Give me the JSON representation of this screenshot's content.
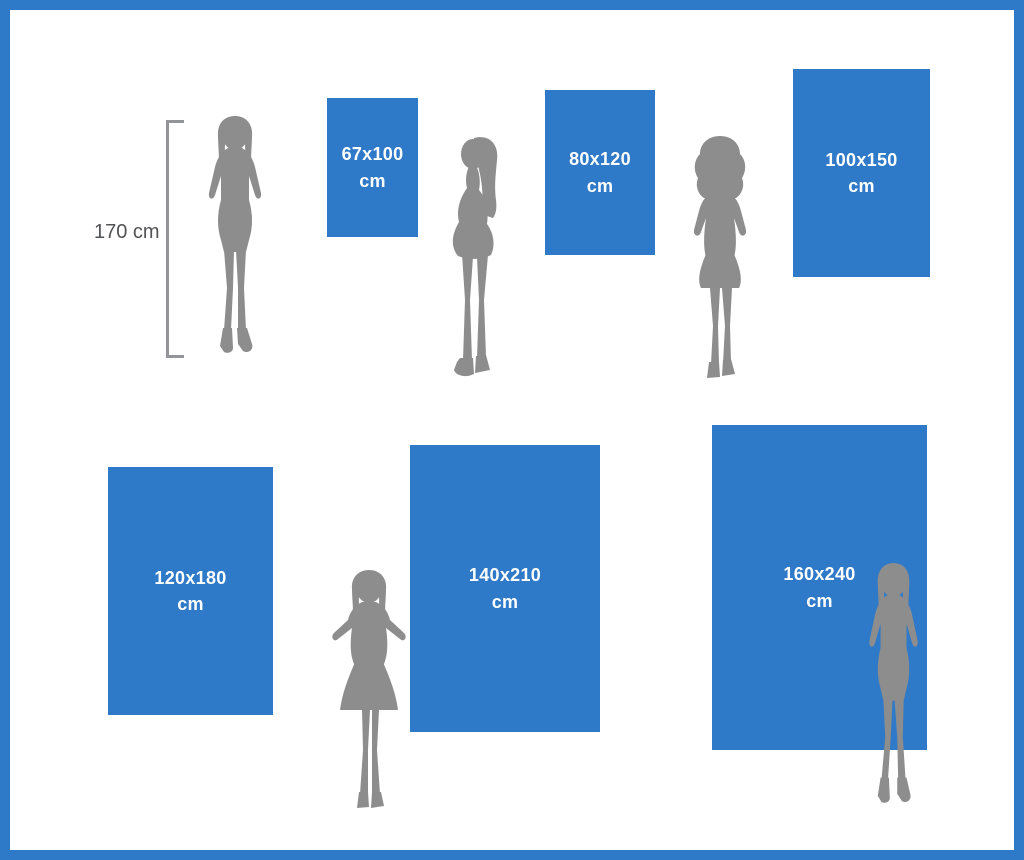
{
  "reference": {
    "height_label": "170 cm"
  },
  "sizes": [
    {
      "dimensions": "67x100",
      "unit": "cm"
    },
    {
      "dimensions": "80x120",
      "unit": "cm"
    },
    {
      "dimensions": "100x150",
      "unit": "cm"
    },
    {
      "dimensions": "120x180",
      "unit": "cm"
    },
    {
      "dimensions": "140x210",
      "unit": "cm"
    },
    {
      "dimensions": "160x240",
      "unit": "cm"
    }
  ],
  "icons": {
    "silhouette_1": "woman-standing-front",
    "silhouette_2": "woman-standing-side",
    "silhouette_3": "woman-curly-hair-front",
    "silhouette_4": "woman-hands-on-hips",
    "silhouette_5": "woman-standing-front",
    "measure": "height-measure-bracket"
  },
  "colors": {
    "accent_blue": "#2e79c8",
    "silhouette_gray": "#8d8d8d",
    "size_label_text": "#ffffff",
    "measure_text": "#525355",
    "background": "#ffffff"
  }
}
